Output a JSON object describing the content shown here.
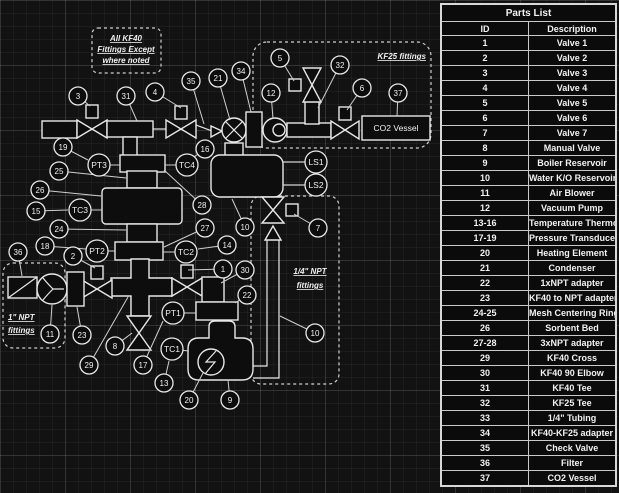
{
  "colors": {
    "background": "#121212",
    "line": "#e8e8e8",
    "text": "#f2f2f2",
    "table_border": "#d8d8d8"
  },
  "notes": {
    "kf40": {
      "lines": [
        "All KF40",
        "Fittings Except",
        "where noted"
      ]
    },
    "kf25": {
      "label": "KF25 fittings"
    },
    "npt1": {
      "lines": [
        "1\" NPT",
        "fittings"
      ]
    },
    "npt quarter": {
      "lines": [
        "1/4\" NPT",
        "fittings"
      ]
    },
    "npt_quarter": {
      "lines": [
        "1/4\" NPT",
        "fittings"
      ]
    }
  },
  "diagram": {
    "vessel_label": "CO2 Vessel",
    "callouts": [
      {
        "id": "3",
        "cx": 78,
        "cy": 96,
        "r": 9,
        "tx": 90,
        "ty": 106
      },
      {
        "id": "31",
        "cx": 126,
        "cy": 96,
        "r": 9,
        "tx": 137,
        "ty": 121
      },
      {
        "id": "4",
        "cx": 155,
        "cy": 92,
        "r": 9,
        "tx": 181,
        "ty": 108
      },
      {
        "id": "35",
        "cx": 191,
        "cy": 81,
        "r": 9,
        "tx": 204,
        "ty": 124
      },
      {
        "id": "21",
        "cx": 218,
        "cy": 78,
        "r": 9,
        "tx": 230,
        "ty": 120
      },
      {
        "id": "34",
        "cx": 241,
        "cy": 71,
        "r": 9,
        "tx": 251,
        "ty": 112
      },
      {
        "id": "5",
        "cx": 280,
        "cy": 58,
        "r": 9,
        "tx": 294,
        "ty": 81
      },
      {
        "id": "12",
        "cx": 271,
        "cy": 93,
        "r": 9,
        "tx": 273,
        "ty": 119
      },
      {
        "id": "32",
        "cx": 340,
        "cy": 65,
        "r": 9,
        "tx": 318,
        "ty": 108
      },
      {
        "id": "6",
        "cx": 362,
        "cy": 88,
        "r": 9,
        "tx": 347,
        "ty": 110
      },
      {
        "id": "37",
        "cx": 398,
        "cy": 93,
        "r": 9,
        "tx": 397,
        "ty": 116
      },
      {
        "id": "19",
        "cx": 63,
        "cy": 147,
        "r": 9,
        "tx": 88,
        "ty": 160
      },
      {
        "id": "16",
        "cx": 205,
        "cy": 149,
        "r": 9,
        "tx": 194,
        "ty": 157
      },
      {
        "id": "25",
        "cx": 59,
        "cy": 171,
        "r": 9,
        "tx": 126,
        "ty": 178
      },
      {
        "id": "26",
        "cx": 40,
        "cy": 190,
        "r": 9,
        "tx": 101,
        "ty": 196
      },
      {
        "id": "15",
        "cx": 36,
        "cy": 211,
        "r": 9,
        "tx": 68,
        "ty": 210
      },
      {
        "id": "24",
        "cx": 59,
        "cy": 229,
        "r": 9,
        "tx": 126,
        "ty": 230
      },
      {
        "id": "18",
        "cx": 45,
        "cy": 246,
        "r": 9,
        "tx": 86,
        "ty": 249
      },
      {
        "id": "28",
        "cx": 202,
        "cy": 205,
        "r": 9,
        "tx": 164,
        "ty": 170
      },
      {
        "id": "27",
        "cx": 205,
        "cy": 228,
        "r": 9,
        "tx": 164,
        "ty": 247
      },
      {
        "id": "14",
        "cx": 227,
        "cy": 245,
        "r": 9,
        "tx": 198,
        "ty": 249
      },
      {
        "id": "10",
        "cx": 245,
        "cy": 227,
        "r": 9,
        "tx": 232,
        "ty": 199
      },
      {
        "id": "36",
        "cx": 18,
        "cy": 252,
        "r": 9,
        "tx": 22,
        "ty": 276
      },
      {
        "id": "2",
        "cx": 73,
        "cy": 256,
        "r": 9,
        "tx": 95,
        "ty": 268
      },
      {
        "id": "1",
        "cx": 223,
        "cy": 269,
        "r": 9,
        "tx": 188,
        "ty": 270
      },
      {
        "id": "30",
        "cx": 245,
        "cy": 270,
        "r": 9,
        "tx": 221,
        "ty": 283
      },
      {
        "id": "22",
        "cx": 247,
        "cy": 295,
        "r": 9,
        "tx": 235,
        "ty": 303
      },
      {
        "id": "7",
        "cx": 318,
        "cy": 228,
        "r": 9,
        "tx": 294,
        "ty": 214
      },
      {
        "id": "10",
        "cx": 315,
        "cy": 333,
        "r": 9,
        "tx": 280,
        "ty": 316
      },
      {
        "id": "23",
        "cx": 82,
        "cy": 335,
        "r": 9,
        "tx": 77,
        "ty": 307
      },
      {
        "id": "11",
        "cx": 50,
        "cy": 334,
        "r": 9,
        "tx": 52,
        "ty": 305
      },
      {
        "id": "8",
        "cx": 115,
        "cy": 346,
        "r": 9,
        "tx": 132,
        "ty": 333
      },
      {
        "id": "29",
        "cx": 89,
        "cy": 365,
        "r": 9,
        "tx": 128,
        "ty": 297
      },
      {
        "id": "17",
        "cx": 143,
        "cy": 365,
        "r": 9,
        "tx": 163,
        "ty": 321
      },
      {
        "id": "13",
        "cx": 164,
        "cy": 383,
        "r": 9,
        "tx": 169,
        "ty": 361
      },
      {
        "id": "20",
        "cx": 189,
        "cy": 400,
        "r": 9,
        "tx": 203,
        "ty": 373
      },
      {
        "id": "9",
        "cx": 230,
        "cy": 400,
        "r": 9,
        "tx": 228,
        "ty": 380
      },
      {
        "id": "PT3",
        "cx": 99,
        "cy": 165,
        "r": 11,
        "tx": 120,
        "ty": 165
      },
      {
        "id": "TC4",
        "cx": 187,
        "cy": 165,
        "r": 11,
        "tx": 165,
        "ty": 165
      },
      {
        "id": "TC3",
        "cx": 80,
        "cy": 210,
        "r": 11,
        "tx": 102,
        "ty": 210
      },
      {
        "id": "PT2",
        "cx": 97,
        "cy": 251,
        "r": 11,
        "tx": 115,
        "ty": 251
      },
      {
        "id": "TC2",
        "cx": 186,
        "cy": 252,
        "r": 11,
        "tx": 163,
        "ty": 252
      },
      {
        "id": "PT1",
        "cx": 173,
        "cy": 313,
        "r": 11,
        "tx": 196,
        "ty": 313
      },
      {
        "id": "TC1",
        "cx": 172,
        "cy": 349,
        "r": 11,
        "tx": 189,
        "ty": 351
      },
      {
        "id": "LS1",
        "cx": 316,
        "cy": 162,
        "r": 11,
        "tx": 283,
        "ty": 162
      },
      {
        "id": "LS2",
        "cx": 316,
        "cy": 185,
        "r": 11,
        "tx": 283,
        "ty": 185
      }
    ]
  },
  "parts_table": {
    "title": "Parts List",
    "columns": [
      "ID",
      "Description"
    ],
    "rows": [
      [
        "1",
        "Valve 1"
      ],
      [
        "2",
        "Valve 2"
      ],
      [
        "3",
        "Valve 3"
      ],
      [
        "4",
        "Valve 4"
      ],
      [
        "5",
        "Valve 5"
      ],
      [
        "6",
        "Valve 6"
      ],
      [
        "7",
        "Valve 7"
      ],
      [
        "8",
        "Manual Valve"
      ],
      [
        "9",
        "Boiler Reservoir"
      ],
      [
        "10",
        "Water K/O Reservoir"
      ],
      [
        "11",
        "Air Blower"
      ],
      [
        "12",
        "Vacuum Pump"
      ],
      [
        "13-16",
        "Temperature Thermocouples"
      ],
      [
        "17-19",
        "Pressure Transducers"
      ],
      [
        "20",
        "Heating Element"
      ],
      [
        "21",
        "Condenser"
      ],
      [
        "22",
        "1xNPT adapter"
      ],
      [
        "23",
        "KF40 to NPT adapter"
      ],
      [
        "24-25",
        "Mesh Centering Rings"
      ],
      [
        "26",
        "Sorbent Bed"
      ],
      [
        "27-28",
        "3xNPT adapter"
      ],
      [
        "29",
        "KF40 Cross"
      ],
      [
        "30",
        "KF40 90 Elbow"
      ],
      [
        "31",
        "KF40 Tee"
      ],
      [
        "32",
        "KF25 Tee"
      ],
      [
        "33",
        "1/4\" Tubing"
      ],
      [
        "34",
        "KF40-KF25 adapter"
      ],
      [
        "35",
        "Check Valve"
      ],
      [
        "36",
        "Filter"
      ],
      [
        "37",
        "CO2 Vessel"
      ]
    ]
  }
}
